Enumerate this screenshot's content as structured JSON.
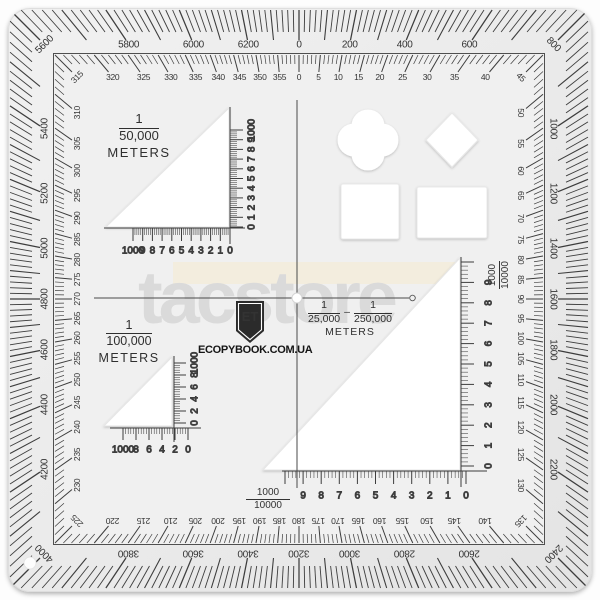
{
  "watermark": {
    "text": "tacstore"
  },
  "brand": {
    "logo_text": "ET",
    "site": "ECOPYBOOK.COM.UA"
  },
  "outer_ring": {
    "unit": "mils",
    "labels": [
      0,
      200,
      400,
      600,
      800,
      1000,
      1200,
      1400,
      1600,
      1800,
      2000,
      2200,
      2400,
      2600,
      2800,
      3000,
      3200,
      3400,
      3600,
      3800,
      4000,
      4200,
      4400,
      4600,
      4800,
      5000,
      5200,
      5400,
      5600,
      5800,
      6000,
      6200
    ]
  },
  "inner_ring": {
    "unit": "degrees",
    "labels": [
      0,
      5,
      10,
      15,
      20,
      25,
      30,
      35,
      40,
      45,
      50,
      55,
      60,
      65,
      70,
      75,
      80,
      85,
      90,
      95,
      100,
      105,
      110,
      115,
      120,
      125,
      130,
      135,
      140,
      145,
      150,
      155,
      160,
      165,
      170,
      175,
      180,
      185,
      190,
      195,
      200,
      205,
      210,
      215,
      220,
      225,
      230,
      235,
      240,
      245,
      250,
      255,
      260,
      265,
      270,
      275,
      280,
      285,
      290,
      295,
      300,
      305,
      310,
      315,
      320,
      325,
      330,
      335,
      340,
      345,
      350,
      355
    ]
  },
  "scale_50k": {
    "numerator": "1",
    "denominator": "50,000",
    "unit": "METERS",
    "h_values": [
      "1000",
      "9",
      "8",
      "7",
      "6",
      "5",
      "4",
      "3",
      "2",
      "1",
      "0"
    ],
    "v_values": [
      "0",
      "1",
      "2",
      "3",
      "4",
      "5",
      "6",
      "7",
      "8",
      "9",
      "1000"
    ]
  },
  "scale_100k": {
    "numerator": "1",
    "denominator": "100,000",
    "unit": "METERS",
    "h_values": [
      "1000",
      "8",
      "6",
      "4",
      "2",
      "0"
    ],
    "v_values": [
      "0",
      "2",
      "4",
      "6",
      "8",
      "1000"
    ]
  },
  "scale_25k_250k": {
    "numerator_a": "1",
    "denominator_a": "25,000",
    "separator": "–",
    "numerator_b": "1",
    "denominator_b": "250,000",
    "unit": "METERS",
    "h_values": [
      "9",
      "8",
      "7",
      "6",
      "5",
      "4",
      "3",
      "2",
      "1",
      "0"
    ],
    "v_values": [
      "0",
      "1",
      "2",
      "3",
      "4",
      "5",
      "6",
      "7",
      "8",
      "9"
    ],
    "bottom_fraction": {
      "numerator": "1000",
      "denominator": "10000"
    },
    "right_fraction": {
      "numerator": "1000",
      "denominator": "10000"
    }
  }
}
